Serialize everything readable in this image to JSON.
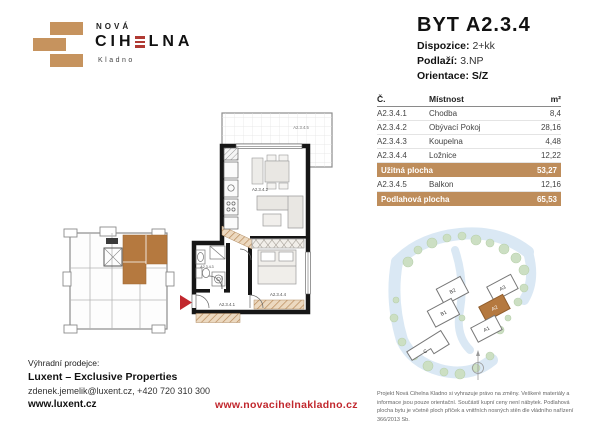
{
  "colors": {
    "brand_tan": "#C6935E",
    "table_tan": "#BE8D5B",
    "accent_red": "#C1272D",
    "logo_red": "#B03A33",
    "site_highlight": "#B5793F"
  },
  "logo": {
    "name_top": "NOVÁ",
    "name_pre": "CIH",
    "name_post": "LNA",
    "city": "Kladno"
  },
  "unit": {
    "title": "BYT A2.3.4",
    "fields": [
      {
        "label": "Dispozice:",
        "value": "2+kk"
      },
      {
        "label": "Podlaží:",
        "value": "3.NP"
      },
      {
        "label": "Orientace:",
        "value": "S/Z"
      }
    ]
  },
  "table": {
    "headers": {
      "no": "Č.",
      "room": "Místnost",
      "area": "m²"
    },
    "rows": [
      {
        "no": "A2.3.4.1",
        "room": "Chodba",
        "area": "8,4"
      },
      {
        "no": "A2.3.4.2",
        "room": "Obývací Pokoj",
        "area": "28,16"
      },
      {
        "no": "A2.3.4.3",
        "room": "Koupelna",
        "area": "4,48"
      },
      {
        "no": "A2.3.4.4",
        "room": "Ložnice",
        "area": "12,22"
      }
    ],
    "usable": {
      "label": "Užitná plocha",
      "value": "53,27"
    },
    "balcony": {
      "no": "A2.3.4.5",
      "room": "Balkon",
      "area": "12,16"
    },
    "total": {
      "label": "Podlahová plocha",
      "value": "65,53"
    }
  },
  "floorplan": {
    "labels": {
      "hall": "A2.3.4.1",
      "living": "A2.3.4.2",
      "bath": "A2.3.4.3",
      "bedroom": "A2.3.4.4",
      "balcony": "A2.3.4.5"
    }
  },
  "siteplan": {
    "buildings": {
      "b2": "B2",
      "b1": "B1",
      "a3": "A3",
      "a2": "A2",
      "a1": "A1",
      "c": "C"
    }
  },
  "footer": {
    "seller_label": "Výhradní prodejce:",
    "seller_name": "Luxent – Exclusive Properties",
    "contact": "zdenek.jemelik@luxent.cz, +420 720 310 300",
    "seller_web": "www.luxent.cz",
    "project_web": "www.novacihelnakladno.cz",
    "disclaimer": "Projekt Nová Cihelna Kladno si vyhrazuje právo na změny. Veškeré materiály a informace jsou pouze orientační. Součástí kupní ceny není nábytek. Podlahová plocha bytu je včetně ploch příček a vnitřních nosných stěn dle vládního nařízení 366/2013 Sb."
  }
}
